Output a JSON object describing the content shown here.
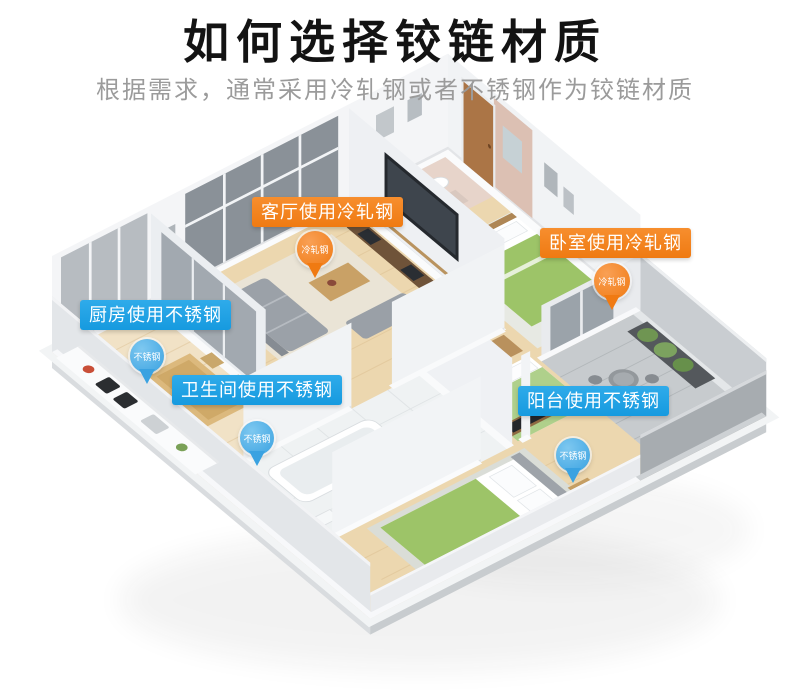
{
  "header": {
    "title": "如何选择铰链材质",
    "subtitle": "根据需求，通常采用冷轧钢或者不锈钢作为铰链材质"
  },
  "materials": {
    "cold_rolled_steel": "冷轧钢",
    "stainless_steel": "不锈钢"
  },
  "colors": {
    "label_orange": "#F5821E",
    "label_blue": "#1FA0E6",
    "pin_orange": "#F07A12",
    "pin_blue": "#3AA2E1",
    "title_text": "#131313",
    "subtitle_text": "#9B9B9B"
  },
  "callouts": {
    "living_room": {
      "room": "客厅",
      "label": "客厅使用冷轧钢",
      "pin_text": "冷轧钢",
      "material": "cold_rolled_steel"
    },
    "bedroom": {
      "room": "卧室",
      "label": "卧室使用冷轧钢",
      "pin_text": "冷轧钢",
      "material": "cold_rolled_steel"
    },
    "kitchen": {
      "room": "厨房",
      "label": "厨房使用不锈钢",
      "pin_text": "不锈钢",
      "material": "stainless_steel"
    },
    "bathroom": {
      "room": "卫生间",
      "label": "卫生间使用不锈钢",
      "pin_text": "不锈钢",
      "material": "stainless_steel"
    },
    "balcony": {
      "room": "阳台",
      "label": "阳台使用不锈钢",
      "pin_text": "不锈钢",
      "material": "stainless_steel"
    }
  }
}
